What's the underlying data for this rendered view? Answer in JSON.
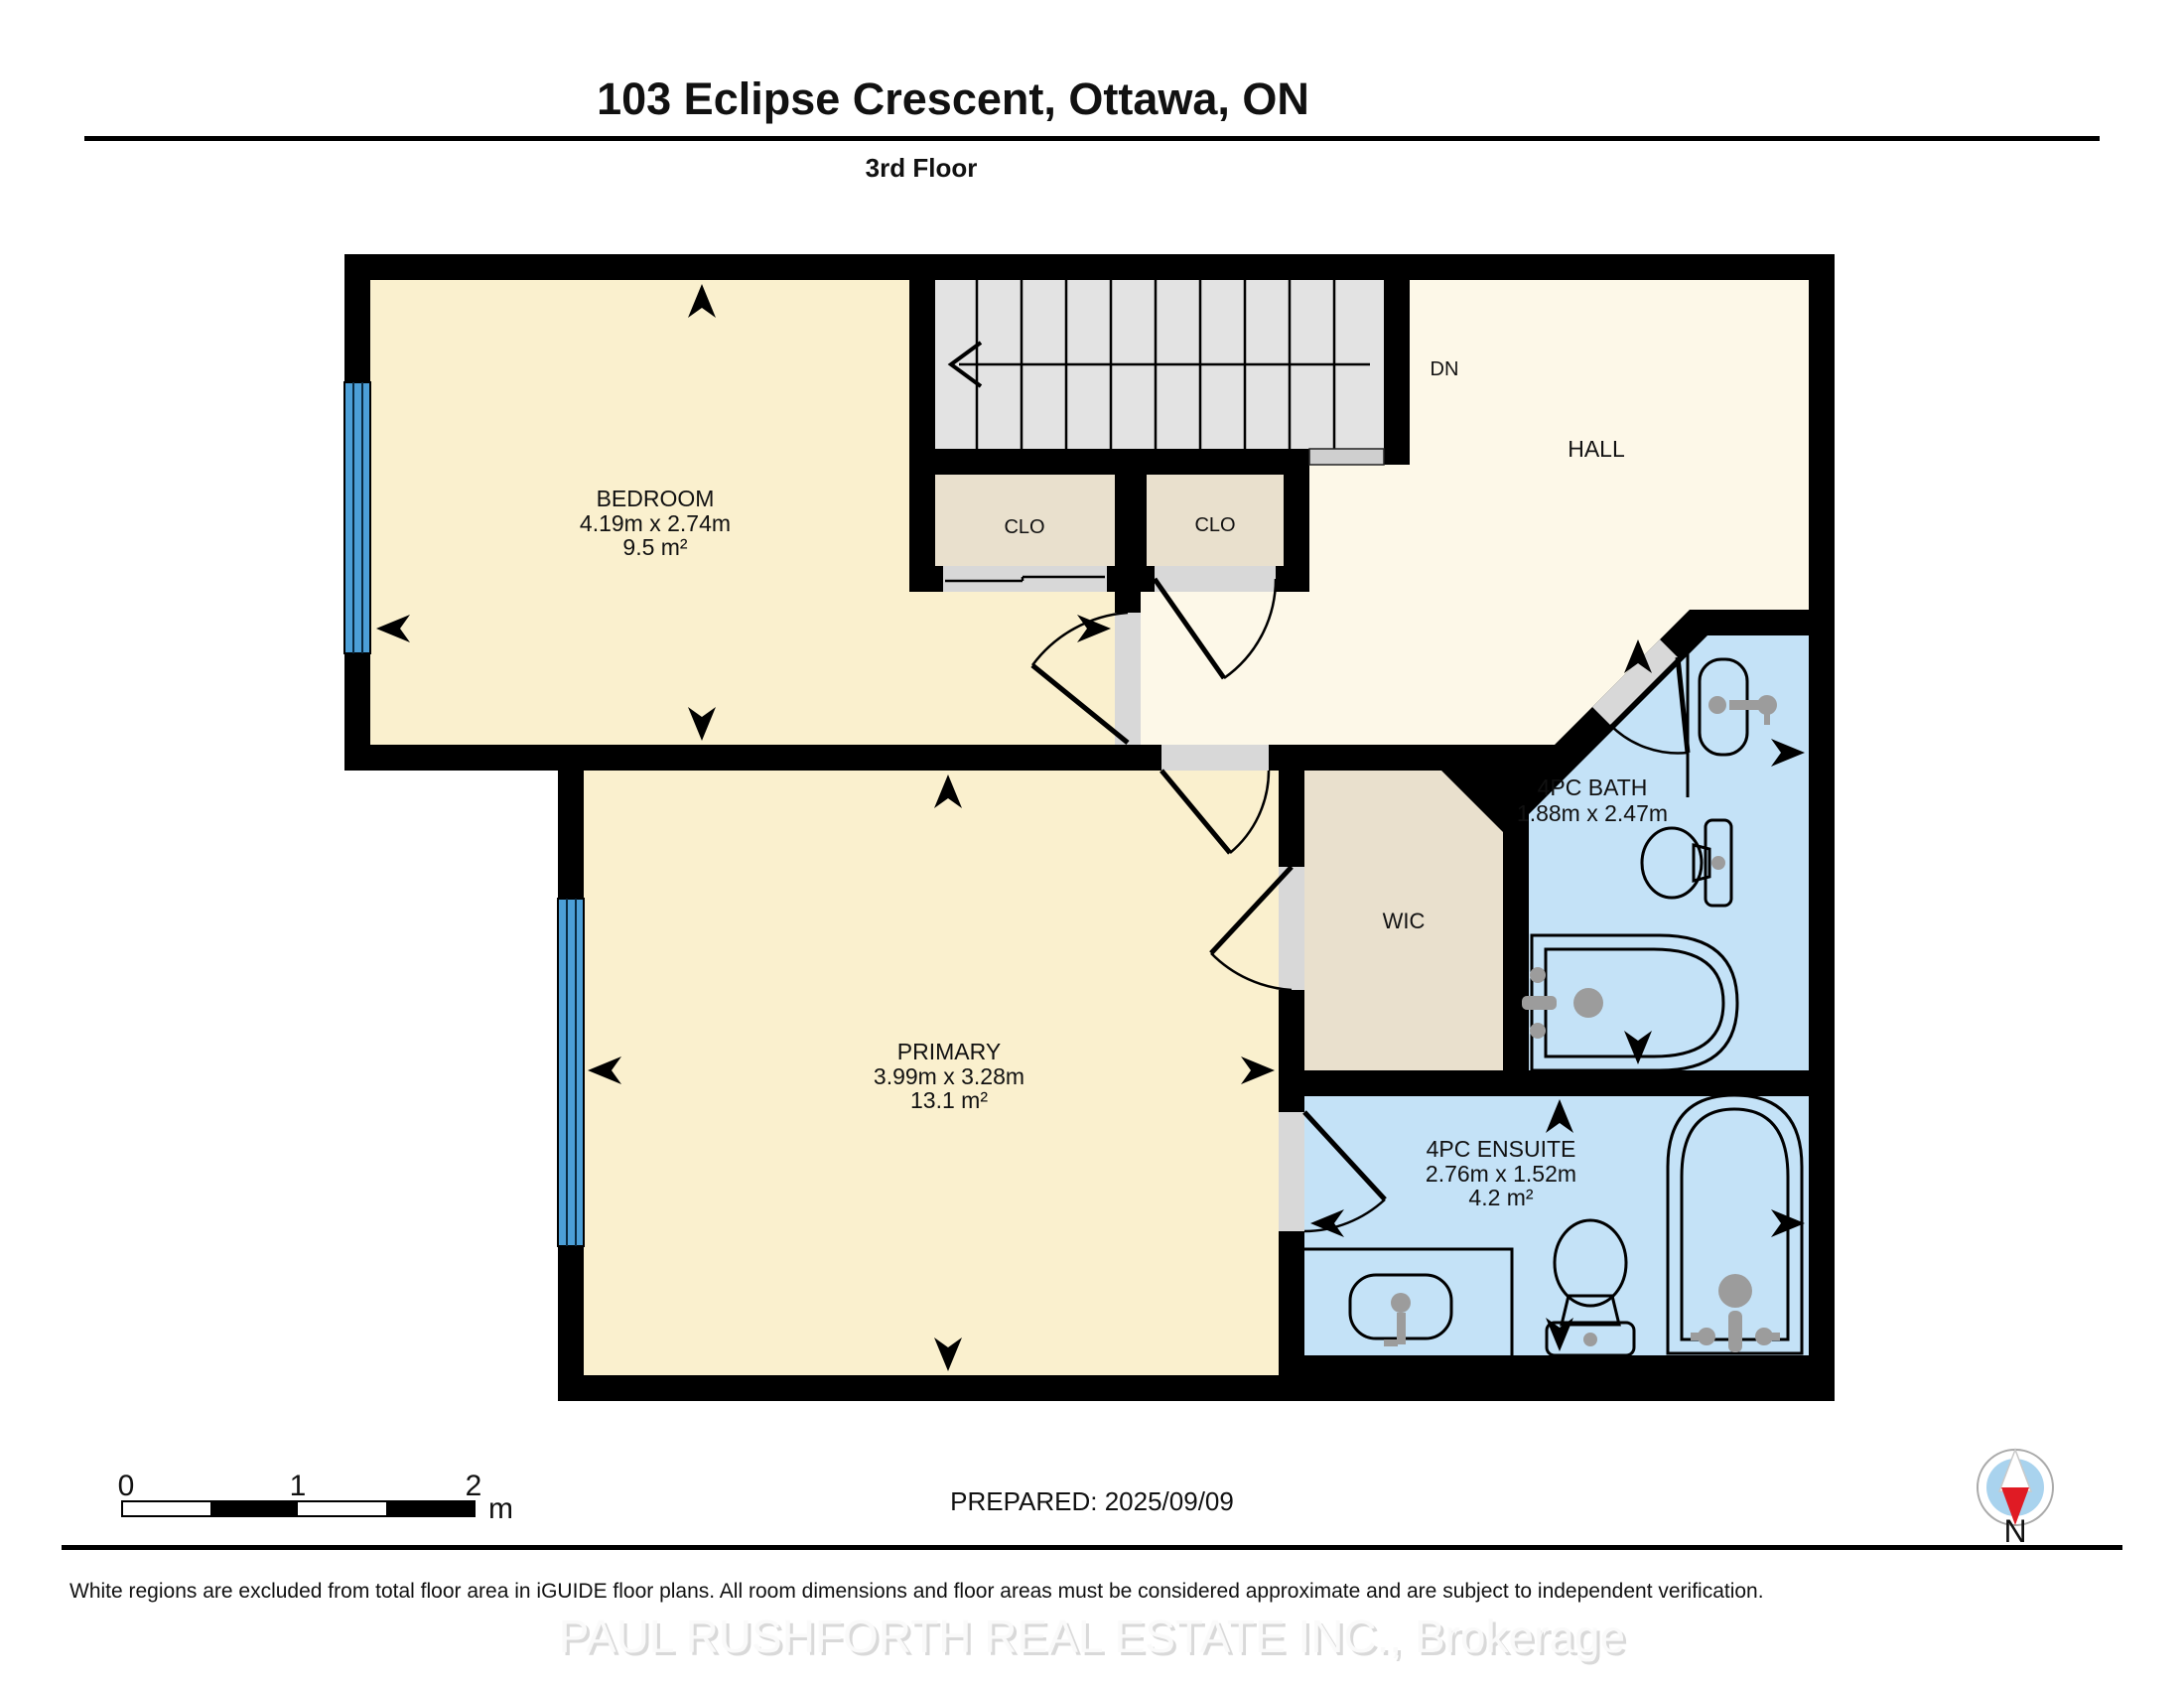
{
  "header": {
    "title": "103 Eclipse Crescent, Ottawa, ON",
    "subtitle": "3rd Floor"
  },
  "rooms": {
    "bedroom": {
      "name": "BEDROOM",
      "dimensions": "4.19m x 2.74m",
      "area": "9.5 m²"
    },
    "primary": {
      "name": "PRIMARY",
      "dimensions": "3.99m x 3.28m",
      "area": "13.1 m²"
    },
    "hall": {
      "name": "HALL"
    },
    "stairs": {
      "direction": "DN"
    },
    "closet1": {
      "name": "CLO"
    },
    "closet2": {
      "name": "CLO"
    },
    "wic": {
      "name": "WIC"
    },
    "bath": {
      "name": "4PC BATH",
      "dimensions": "1.88m x 2.47m"
    },
    "ensuite": {
      "name": "4PC ENSUITE",
      "dimensions": "2.76m x 1.52m",
      "area": "4.2 m²"
    }
  },
  "scale_bar": {
    "tick0": "0",
    "tick1": "1",
    "tick2": "2",
    "unit": "m"
  },
  "footer": {
    "prepared": "PREPARED: 2025/09/09",
    "disclaimer": "White regions are excluded from total floor area in iGUIDE floor plans. All room dimensions and floor areas must be considered approximate and are subject to independent verification.",
    "watermark": "PAUL RUSHFORTH REAL ESTATE INC., Brokerage"
  },
  "compass": {
    "label": "N"
  },
  "colors": {
    "wall": "#000000",
    "room_cream": "#FAF0CE",
    "hall_cream": "#FDF8E8",
    "closet_beige": "#E9E0CD",
    "bath_blue": "#C4E2F7",
    "stairs_gray": "#E3E3E3",
    "landing_gray": "#CFCFCF",
    "opening_gray": "#D8D8D8",
    "window_blue": "#4C9FD7",
    "fixture_gray": "#9C9C9C",
    "compass_red": "#E01B24",
    "compass_blue": "#A9D3EE"
  }
}
